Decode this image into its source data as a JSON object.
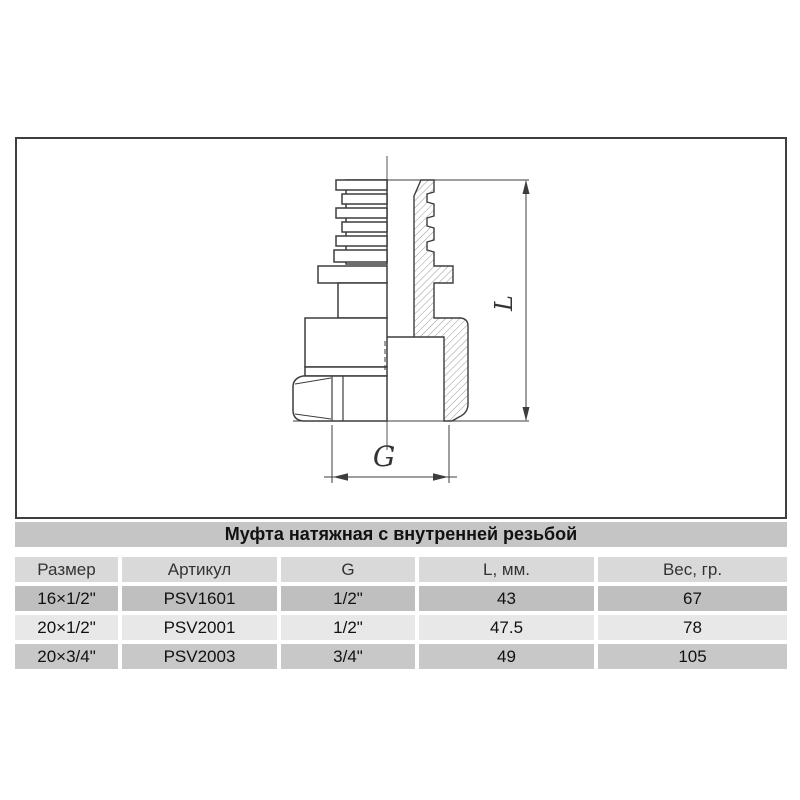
{
  "drawing": {
    "description": "Cross-section technical drawing of a tension coupling fitting with barbed pipe end, flange, body and hex nut",
    "dim_vertical_label": "L",
    "dim_horizontal_label": "G"
  },
  "table": {
    "title": "Муфта натяжная с внутренней резьбой",
    "columns": [
      "Размер",
      "Артикул",
      "G",
      "L, мм.",
      "Вес, гр."
    ],
    "rows": [
      [
        "16×1/2\"",
        "PSV1601",
        "1/2\"",
        "43",
        "67"
      ],
      [
        "20×1/2\"",
        "PSV2001",
        "1/2\"",
        "47.5",
        "78"
      ],
      [
        "20×3/4\"",
        "PSV2003",
        "3/4\"",
        "49",
        "105"
      ]
    ]
  },
  "colors": {
    "page_bg": "#ffffff",
    "box_border": "#3f3f3f",
    "line": "#3d3d3d",
    "hatch": "#8f8f8f",
    "title_bar_bg": "#c5c5c5",
    "header_bg": "#d9d9d9",
    "row_bg_1": "#bfbfbf",
    "row_bg_2": "#e8e8e8",
    "row_bg_3": "#c8c8c8",
    "text": "#111111"
  }
}
